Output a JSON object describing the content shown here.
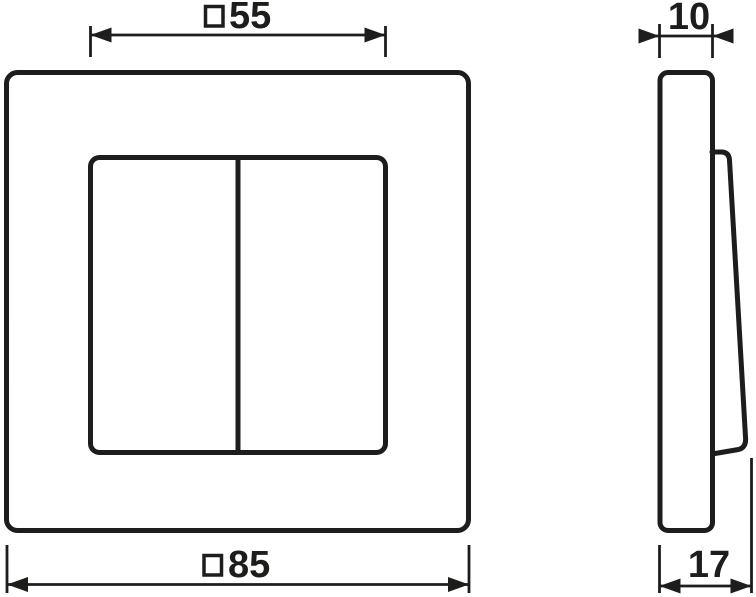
{
  "colors": {
    "line": "#1d1d1b",
    "background": "#ffffff"
  },
  "front_view": {
    "inner_dimension": {
      "symbol": "□",
      "value": "55"
    },
    "outer_dimension": {
      "symbol": "□",
      "value": "85"
    }
  },
  "side_view": {
    "width_dimension": {
      "value": "10"
    },
    "depth_dimension": {
      "value": "17"
    }
  }
}
